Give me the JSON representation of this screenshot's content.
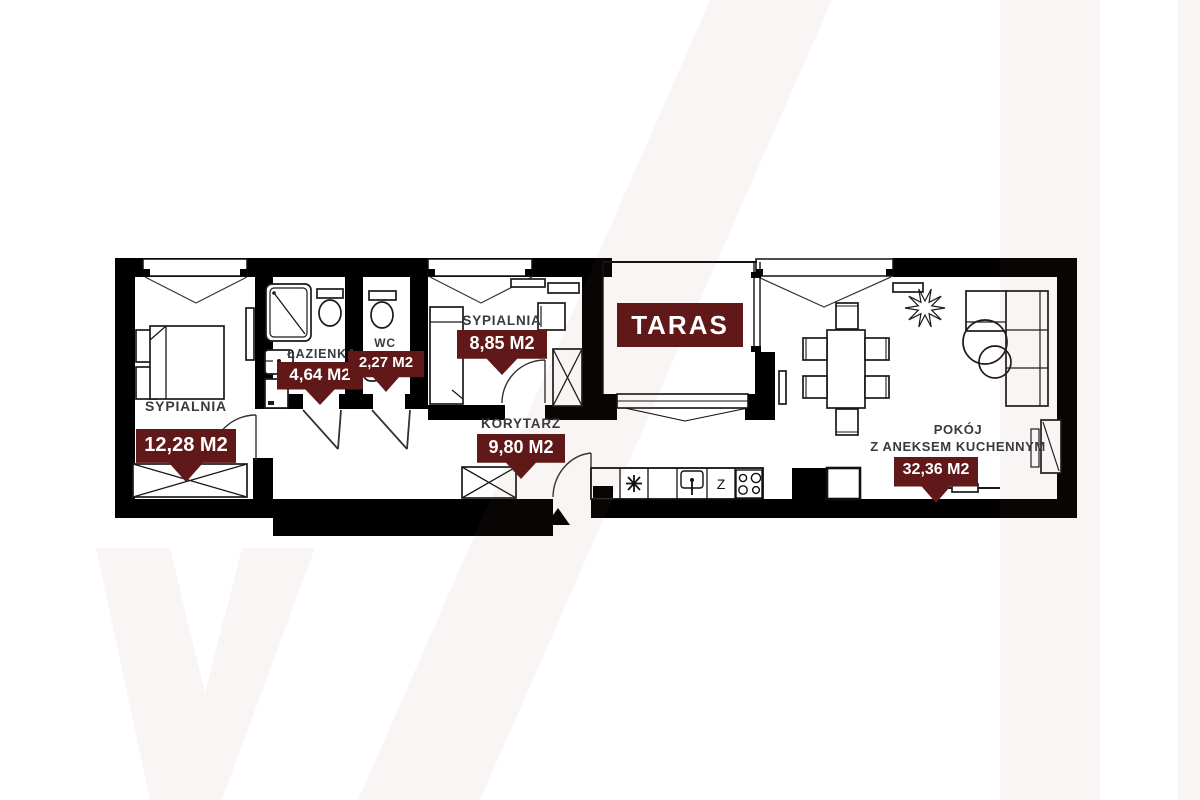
{
  "title": "Apartment floor plan",
  "colors": {
    "banner": "#601818",
    "wall": "#000000",
    "label_text": "#3a3a3a",
    "watermark": "#f7f0f0"
  },
  "rooms": {
    "bedroom1": {
      "name": "SYPIALNIA",
      "area": "12,28 M2"
    },
    "bathroom": {
      "name": "ŁAZIENKA",
      "area": "4,64 M2"
    },
    "wc": {
      "name": "WC",
      "area": "2,27 M2"
    },
    "bedroom2": {
      "name": "SYPIALNIA",
      "area": "8,85 M2"
    },
    "corridor": {
      "name": "KORYTARZ",
      "area": "9,80 M2"
    },
    "terrace": {
      "name": "TARAS"
    },
    "living": {
      "name_line1": "POKÓJ",
      "name_line2": "Z ANEKSEM KUCHENNYM",
      "area": "32,36 M2"
    }
  },
  "kitchen": {
    "dishwasher_label": "Z"
  }
}
